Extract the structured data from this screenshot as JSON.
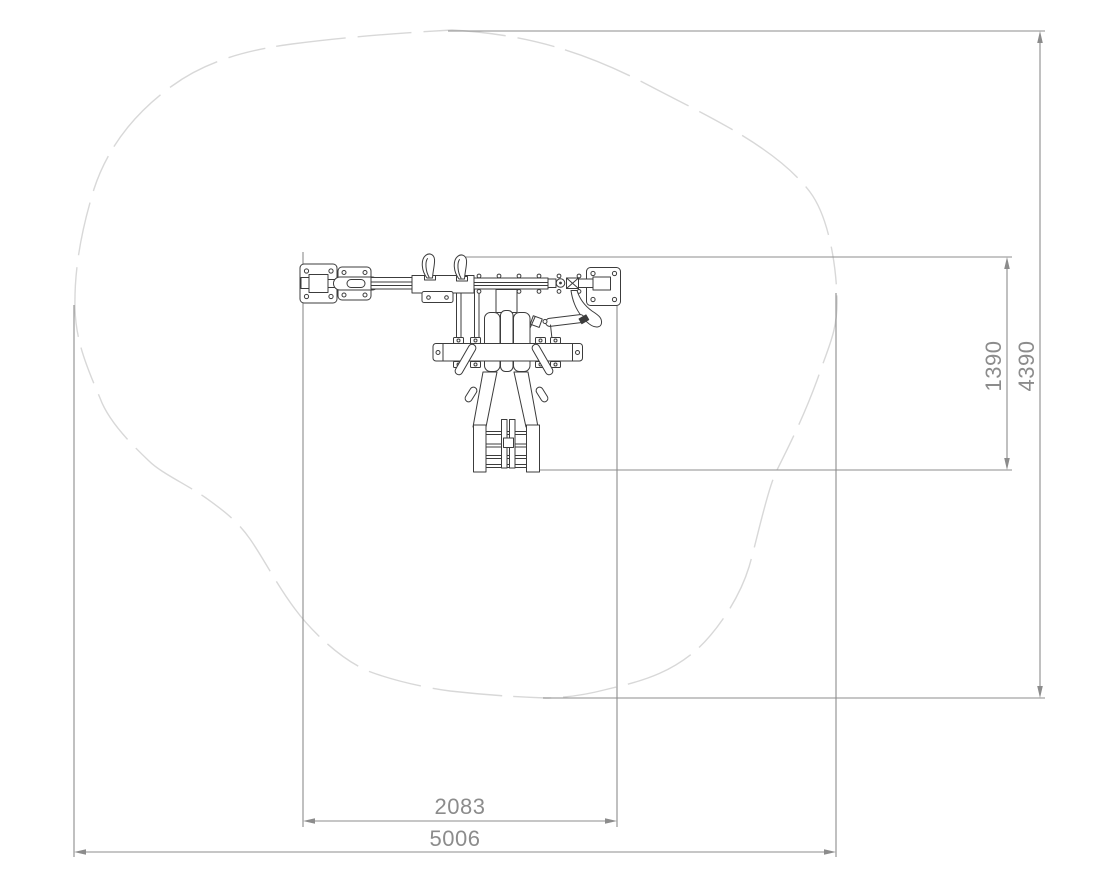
{
  "page": {
    "background_color": "#ffffff",
    "content_type": "technical plan-view drawing with dimensions"
  },
  "dimensions": {
    "equipment_width": "2083",
    "overall_width": "5006",
    "equipment_depth": "1390",
    "overall_depth": "4390"
  },
  "colors": {
    "dimension_lines": "#8c8c8c",
    "dimension_text": "#8c8c8c",
    "equipment_outline": "#3c3c3c",
    "safety_area_outline": "#d8d8d8"
  }
}
